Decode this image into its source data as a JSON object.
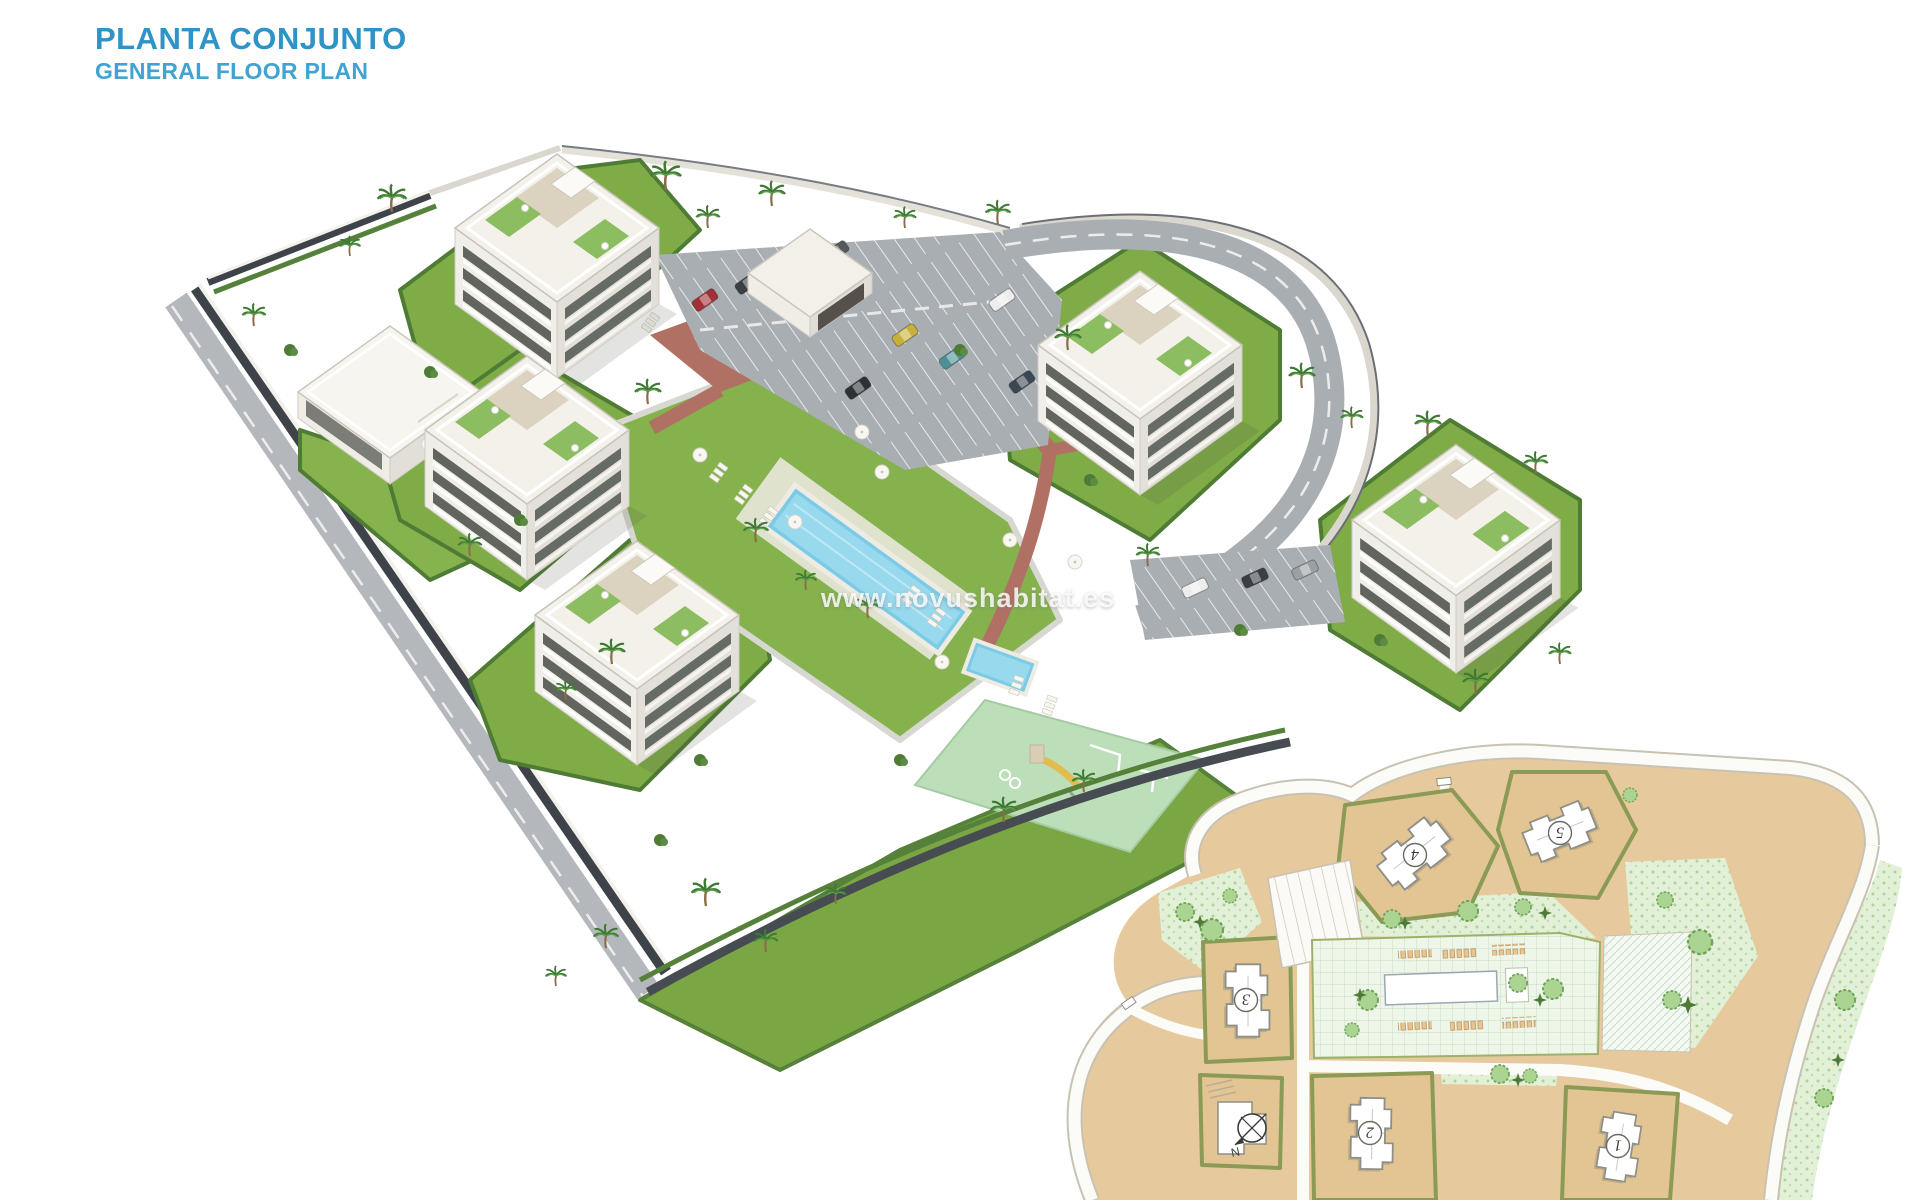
{
  "header": {
    "title": "PLANTA CONJUNTO",
    "subtitle": "GENERAL FLOOR PLAN"
  },
  "watermark": {
    "text": "www.novushabitat.es"
  },
  "site_plan": {
    "compass_label": "N",
    "buildings": [
      {
        "label": "1"
      },
      {
        "label": "2"
      },
      {
        "label": "3"
      },
      {
        "label": "4"
      },
      {
        "label": "5"
      }
    ]
  },
  "palette": {
    "title_blue": "#2E93C6",
    "subtitle_blue": "#41A3D2",
    "pool_blue": "#7CCBE6",
    "lawn_green": "#7FAC47",
    "hedge_green": "#4F7C35",
    "playground_mint": "#BCDFBA",
    "brick_path": "#B07164",
    "asphalt_gray": "#A9AEB3",
    "boundary_dark": "#3E4349",
    "building_white": "#F3F1EA",
    "plan_land_tan": "#E6CA9D",
    "plan_olive": "#8B9A55",
    "plan_green": "#DCEDD2",
    "watermark_white": "rgba(255,255,255,0.82)"
  }
}
